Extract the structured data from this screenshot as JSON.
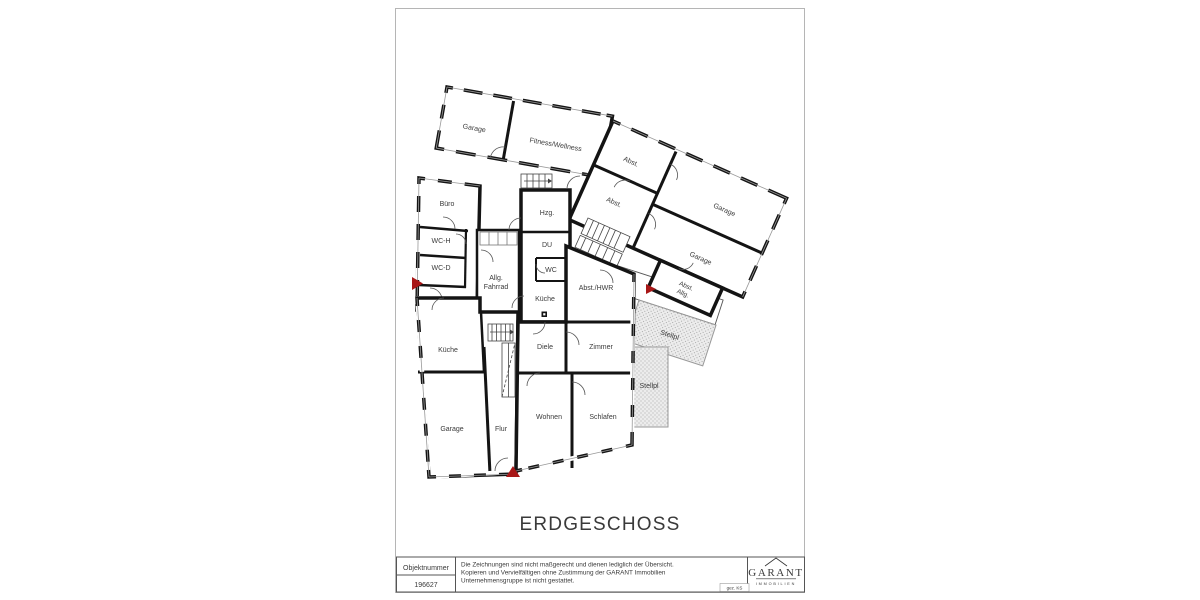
{
  "page": {
    "title": "ERDGESCHOSS",
    "background": "#ffffff"
  },
  "plan": {
    "rooms": {
      "garage_top": "Garage",
      "fitness": "Fitness/Wellness",
      "abst_1": "Abst.",
      "abst_2": "Abst.",
      "garage_right_upper": "Garage",
      "garage_right_lower": "Garage",
      "abst_allg_l1": "Abst.",
      "abst_allg_l2": "Allg.",
      "buero": "Büro",
      "wc_h": "WC-H",
      "wc_d": "WC-D",
      "allg_fahrrad_l1": "Allg.",
      "allg_fahrrad_l2": "Fahrrad",
      "hzg": "Hzg.",
      "du": "DU",
      "wc": "WC",
      "kueche_mitte": "Küche",
      "abst_hwr": "Abst./HWR",
      "stellplatz_1": "Stellpl",
      "stellplatz_2": "Stellpl",
      "kueche_links": "Küche",
      "diele": "Diele",
      "zimmer": "Zimmer",
      "garage_unten": "Garage",
      "flur": "Flur",
      "wohnen": "Wohnen",
      "schlafen": "Schlafen"
    }
  },
  "footer": {
    "objektnummer_label": "Objektnummer",
    "objektnummer_value": "196627",
    "disclaimer_line1": "Die Zeichnungen sind nicht maßgerecht und dienen lediglich der Übersicht.",
    "disclaimer_line2": "Kopieren und Vervielfältigen ohne Zustimmung der GARANT Immobilien",
    "disclaimer_line3": "Unternehmensgruppe ist nicht gestattet.",
    "signature": "gez. KS",
    "brand_name": "GARANT",
    "brand_subtitle": "IMMOBILIEN"
  },
  "colors": {
    "wall": "#141414",
    "entrance_marker": "#a81717",
    "stellplatz_fill": "#ececec",
    "stellplatz_dot": "#9a9a9a",
    "page_border": "#b5b5b5"
  }
}
